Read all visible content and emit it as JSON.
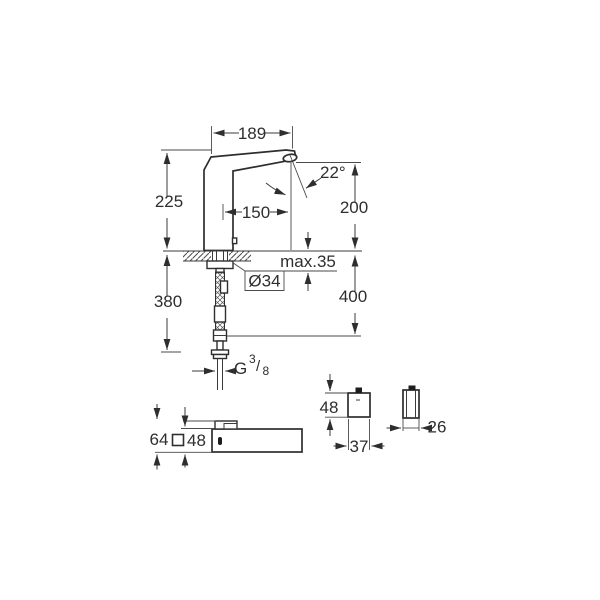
{
  "page": {
    "background": "#ffffff",
    "line_color": "#2e2e2e"
  },
  "views": {
    "side_elevation": {
      "label": "faucet-side-elevation",
      "dims": {
        "spout_length": "189",
        "spray_angle": "22°",
        "height_above_deck": "225",
        "spout_reach": "150",
        "outlet_height": "200",
        "deck_thickness": "max.35",
        "hole_diameter": "Ø34",
        "supply_depth_left": "380",
        "supply_depth_right": "400",
        "thread_letter": "G",
        "thread_numerator": "3",
        "thread_slash": "/",
        "thread_denominator": "8"
      }
    },
    "plan_view": {
      "label": "faucet-plan-view",
      "dims": {
        "total_depth": "64",
        "body_square": "48"
      }
    },
    "control_front_view": {
      "label": "control-box-front-view",
      "dims": {
        "height": "48",
        "width": "37"
      }
    },
    "control_side_view": {
      "label": "control-box-side-view",
      "dims": {
        "depth": "26"
      }
    }
  }
}
